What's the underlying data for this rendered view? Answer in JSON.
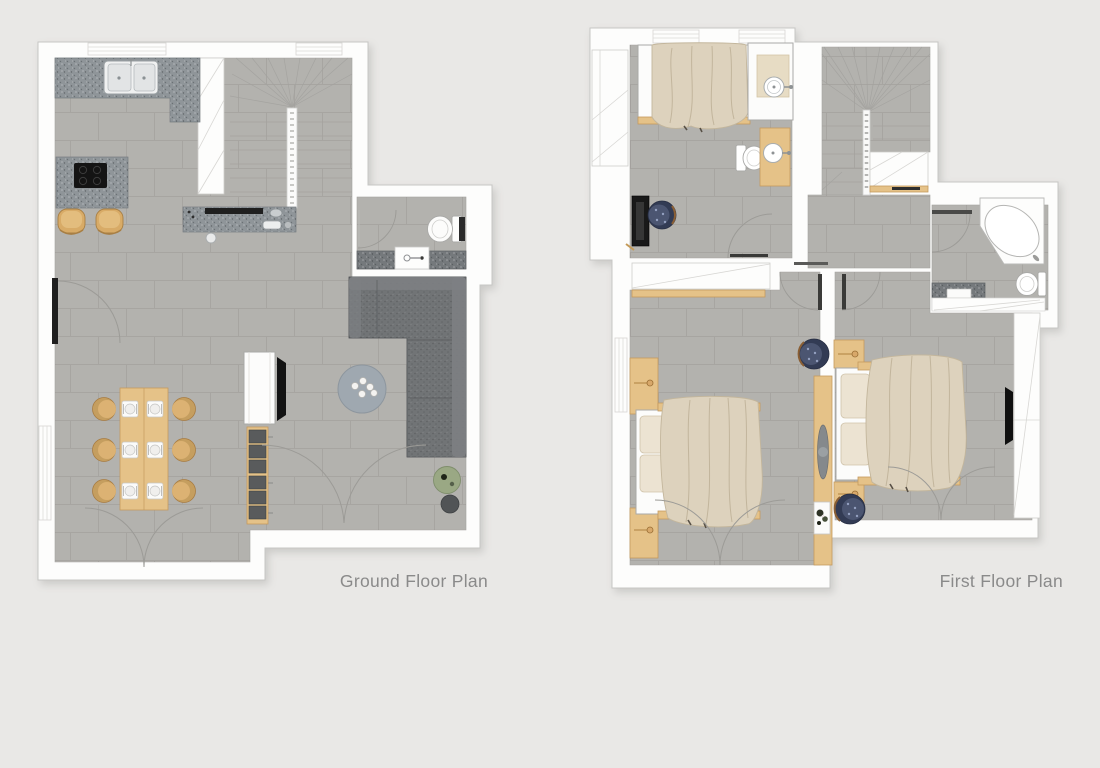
{
  "labels": {
    "ground_floor_plan": "Ground Floor Plan",
    "first_floor_plan": "First Floor Plan"
  },
  "palette": {
    "bg": "#e9e8e6",
    "wall-white": "#fdfdfc",
    "wall-outline": "#c6c6c4",
    "floor": "#b3b2ae",
    "counter": "#8f9599",
    "counter-dark": "#75797c",
    "wood": "#e5c288",
    "wood-dark": "#c49a5e",
    "sofa": "#717476",
    "sofa-light": "#7d8083",
    "duvet": "#ddd2bd",
    "pillow": "#ece3d2",
    "navy-chair": "#4b5571",
    "plant-green": "#9aa884",
    "table-blue": "#9fa8b0",
    "fixture-white": "#fcfcfb",
    "fixture-outline": "#a9a9a7",
    "arc-line": "#9c9b97",
    "dark-item": "#1c1c1c",
    "label-text": "#8a8a8a"
  },
  "ground_floor": {
    "label": "Ground Floor Plan",
    "rooms": [
      "open-plan kitchen dining living",
      "winder staircase",
      "wc"
    ],
    "furniture": [
      "kitchen counter with double sink",
      "kitchen island with hob",
      "two bar stools",
      "peninsula counter with cooktop items",
      "under-stair closet",
      "dining table with six chairs and six place settings",
      "tv cabinet with tv",
      "storage bench with six cushions",
      "l-shaped sofa",
      "round coffee table with five cups",
      "potted plant",
      "round side table",
      "entry door",
      "double garden doors",
      "double patio doors",
      "wc toilet",
      "wc vanity with basin"
    ]
  },
  "first_floor": {
    "label": "First Floor Plan",
    "rooms": [
      "bedroom one with ensuite corner",
      "stairs",
      "landing",
      "bathroom",
      "bedroom two",
      "bedroom three"
    ],
    "furniture": [
      "single bed with duvet",
      "washbasin platform",
      "ensuite toilet",
      "wooden vanity with basin",
      "desk with office chair",
      "winder staircase",
      "under-stair closet",
      "corner bathtub",
      "bathroom toilet",
      "bathroom vanity",
      "double bed with duvet and two pillows",
      "bedside cabinets with knobs",
      "navy armchair",
      "wardrobe column with decor shelf and plant table",
      "second double bed with duvet and two pillows",
      "second navy armchair",
      "wall tv",
      "built-in wardrobe",
      "double doors to balcony"
    ]
  }
}
